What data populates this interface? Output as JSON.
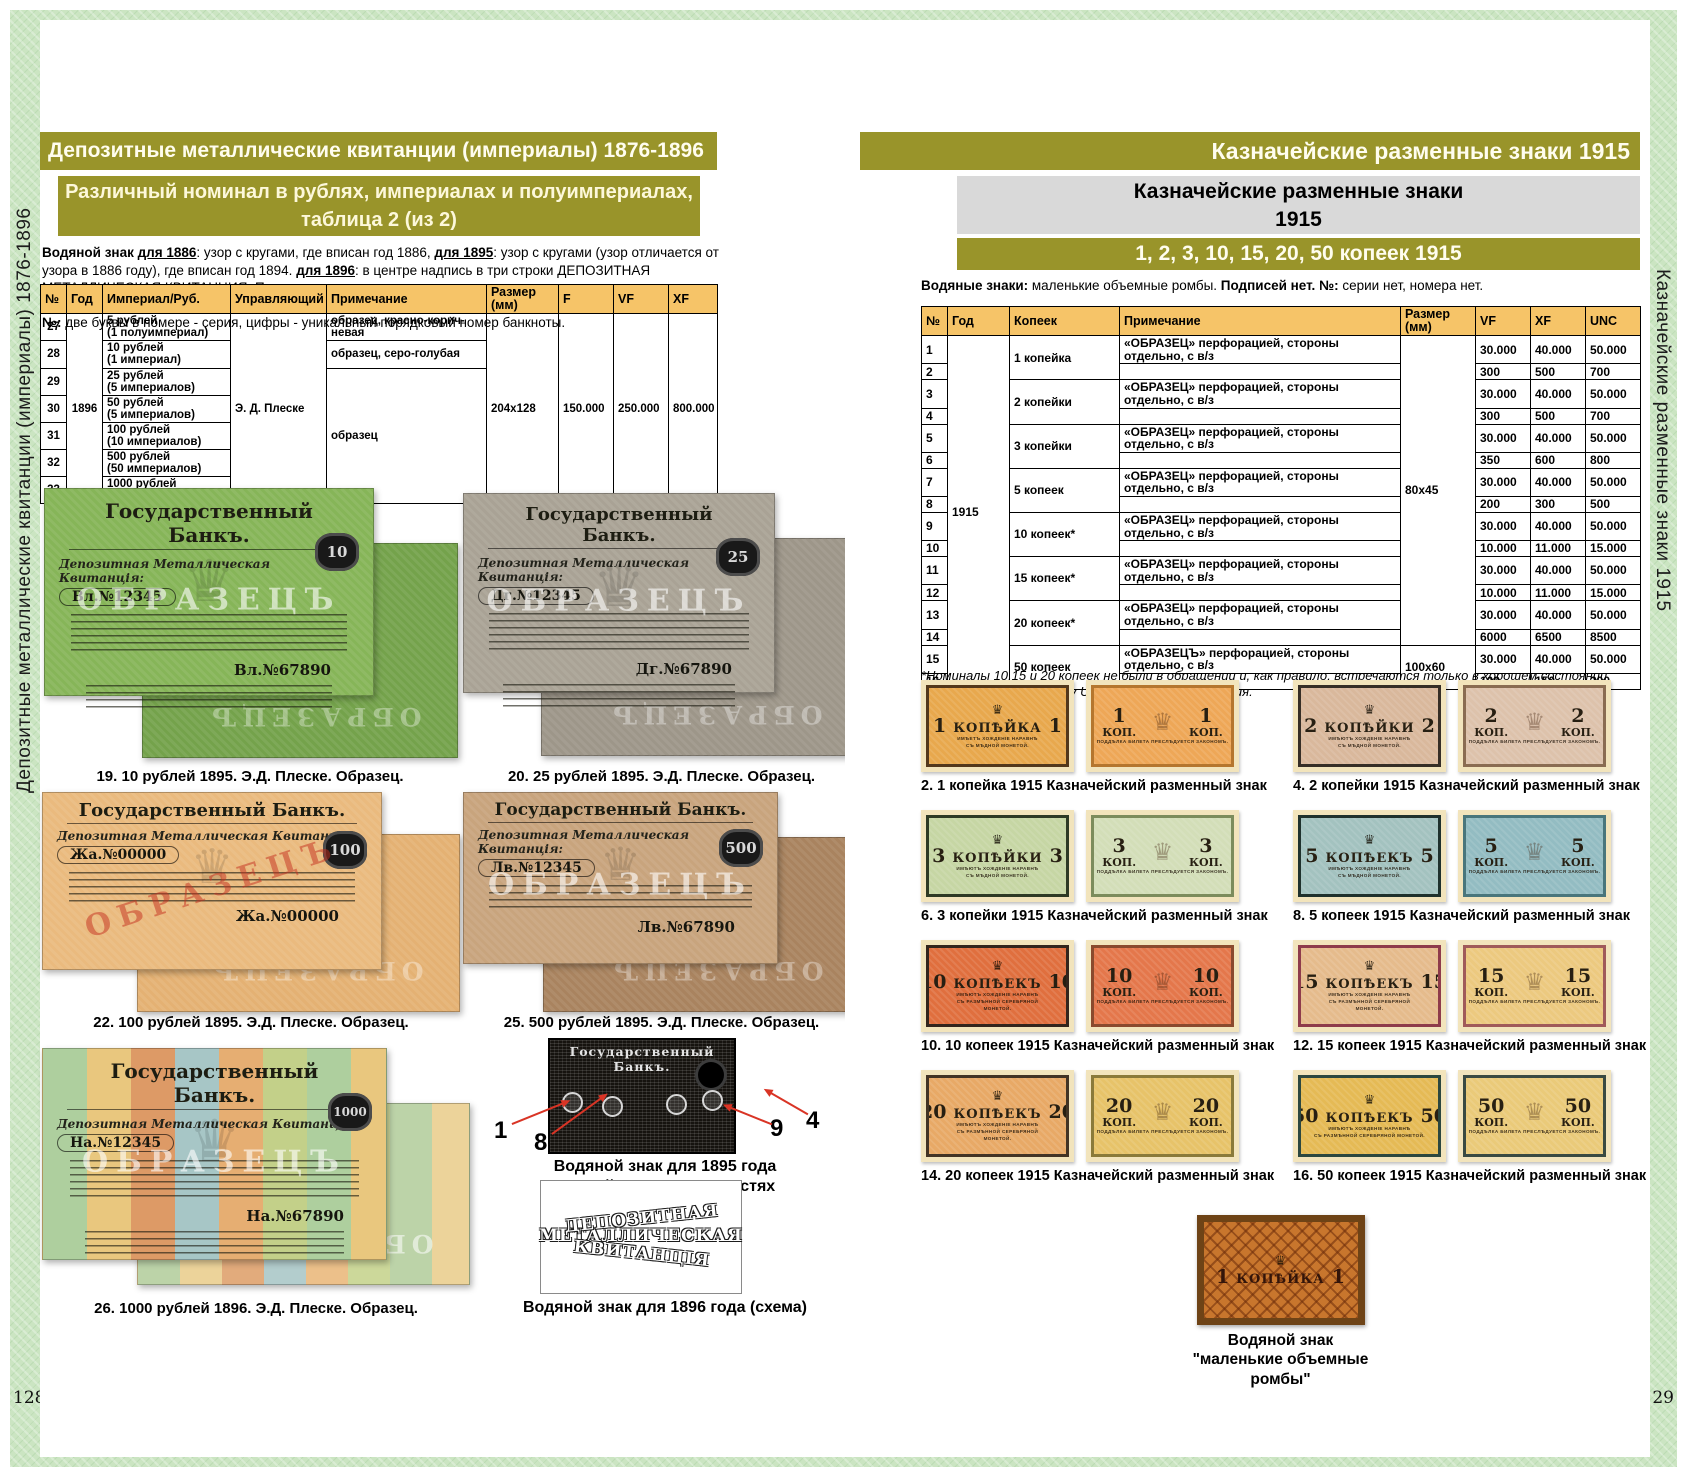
{
  "colors": {
    "accent_olive": "#99942a",
    "table_header": "#f6c468",
    "frame_green": "#cbe5c2",
    "arrow_red": "#d93425"
  },
  "icons": {
    "eagle": "♛"
  },
  "frame": {
    "sidebar_left": "Депозитные металлические квитанции (империалы) 1876-1896",
    "sidebar_right": "Казначейские разменные знаки 1915",
    "page_number_left": "128",
    "page_number_right": "129"
  },
  "left_page": {
    "header": "Депозитные металлические квитанции (империалы) 1876-1896",
    "subheader_line1": "Различный номинал в рублях, империалах и полуимпериалах,",
    "subheader_line2": "таблица 2 (из 2)",
    "intro": {
      "s1": "Водяной знак ",
      "s2": "для 1886",
      "s3": ": узор с кругами, где вписан год 1886, ",
      "s4": "для 1895",
      "s5": ": узор с кругами (узор отличается от узора в 1886 году), где вписан год 1894. ",
      "s6": "для 1896",
      "s7": ": в центре надпись в три строки ДЕПОЗИТНАЯ МЕТАЛЛИЧЕСКАЯ КВИТАНЦИЯ. По остальным годам водяные знаки автору неизвестны, если у вас есть информация, пишите на books@coinsmoscow.ru.",
      "s8": "№:",
      "s9": " две буквы в номере - серия, цифры - уникальный порядковый номер банкноты."
    },
    "table": {
      "headers": [
        "№",
        "Год",
        "Империал/Руб.",
        "Управляющий",
        "Примечание",
        "Размер (мм)",
        "F",
        "VF",
        "XF"
      ],
      "year": "1896",
      "manager": "Э. Д. Плеске",
      "size": "204x128",
      "f": "150.000",
      "vf": "250.000",
      "xf": "800.000",
      "note_27": "образец, красно-корич-невая",
      "note_28": "образец, серо-голубая",
      "note_29_33": "образец",
      "rows": [
        {
          "no": "27",
          "denom": "5 рублей\n(1 полуимпериал)"
        },
        {
          "no": "28",
          "denom": "10 рублей\n(1 империал)"
        },
        {
          "no": "29",
          "denom": "25 рублей\n(5 империалов)"
        },
        {
          "no": "30",
          "denom": "50 рублей\n(5 империалов)"
        },
        {
          "no": "31",
          "denom": "100 рублей\n(10 империалов)"
        },
        {
          "no": "32",
          "denom": "500 рублей\n(50 империалов)"
        },
        {
          "no": "33",
          "denom": "1000 рублей\n(100 империалов)"
        }
      ]
    },
    "bank_title": "Государственный Банкъ.",
    "bank_subtitle": "Депозитная Металлическая Квитанція:",
    "sample_overlay": "ОБРАЗЕЦЪ",
    "figures": [
      {
        "caption": "19. 10 рублей 1895. Э.Д. Плеске. Образец.",
        "serial1": "Вл.№12345",
        "serial2": "Вл.№67890",
        "badge": "10"
      },
      {
        "caption": "20. 25 рублей 1895. Э.Д. Плеске. Образец.",
        "serial1": "Дг.№12345",
        "serial2": "Дг.№67890",
        "badge": "25"
      },
      {
        "caption": "22. 100 рублей 1895. Э.Д. Плеске. Образец.",
        "serial1": "Жа.№00000",
        "serial2": "Жа.№00000",
        "badge": "100"
      },
      {
        "caption": "25. 500 рублей 1895. Э.Д. Плеске. Образец.",
        "serial1": "Лв.№12345",
        "serial2": "Лв.№67890",
        "badge": "500"
      },
      {
        "caption": "26. 1000 рублей 1896. Э.Д. Плеске. Образец.",
        "serial1": "На.№12345",
        "serial2": "На.№67890",
        "badge": "1000"
      }
    ],
    "wm1895": {
      "labels": [
        "1",
        "8",
        "9",
        "4"
      ],
      "caption_line1": "Водяной знак для 1895 года",
      "caption_line2": "с датой 1894 в окружностях"
    },
    "wm1896": {
      "arc1": "ДЕПОЗИТНАЯ",
      "arc2": "МЕТАЛЛИЧЕСКАЯ",
      "arc3": "КВИТАНЦІЯ",
      "caption": "Водяной знак для 1896 года (схема)"
    }
  },
  "right_page": {
    "header": "Казначейские разменные знаки 1915",
    "graybox_line1": "Казначейские разменные знаки",
    "graybox_line2": "1915",
    "subbar": "1, 2, 3, 10, 15, 20, 50 копеек 1915",
    "intro": {
      "s1": "Водяные знаки:",
      "s2": " маленькие объемные ромбы. ",
      "s3": "Подписей нет.",
      "s4": " ",
      "s5": "№:",
      "s6": " серии нет, номера нет."
    },
    "table": {
      "headers": [
        "№",
        "Год",
        "Копеек",
        "Примечание",
        "Размер (мм)",
        "VF",
        "XF",
        "UNC"
      ],
      "year": "1915",
      "size_small": "80x45",
      "size_large": "100x60",
      "note": "«ОБРАЗЕЦ» перфорацией, стороны отдельно, с в/з",
      "note_50": "«ОБРАЗЕЦЪ» перфорацией, стороны отдельно, с в/з",
      "kopeks": [
        "1 копейка",
        "2 копейки",
        "3 копейки",
        "5 копеек",
        "10 копеек*",
        "15 копеек*",
        "20 копеек*",
        "50 копеек"
      ],
      "rows": [
        {
          "no": "1",
          "vf": "30.000",
          "xf": "40.000",
          "unc": "50.000"
        },
        {
          "no": "2",
          "vf": "300",
          "xf": "500",
          "unc": "700"
        },
        {
          "no": "3",
          "vf": "30.000",
          "xf": "40.000",
          "unc": "50.000"
        },
        {
          "no": "4",
          "vf": "300",
          "xf": "500",
          "unc": "700"
        },
        {
          "no": "5",
          "vf": "30.000",
          "xf": "40.000",
          "unc": "50.000"
        },
        {
          "no": "6",
          "vf": "350",
          "xf": "600",
          "unc": "800"
        },
        {
          "no": "7",
          "vf": "30.000",
          "xf": "40.000",
          "unc": "50.000"
        },
        {
          "no": "8",
          "vf": "200",
          "xf": "300",
          "unc": "500"
        },
        {
          "no": "9",
          "vf": "30.000",
          "xf": "40.000",
          "unc": "50.000"
        },
        {
          "no": "10",
          "vf": "10.000",
          "xf": "11.000",
          "unc": "15.000"
        },
        {
          "no": "11",
          "vf": "30.000",
          "xf": "40.000",
          "unc": "50.000"
        },
        {
          "no": "12",
          "vf": "10.000",
          "xf": "11.000",
          "unc": "15.000"
        },
        {
          "no": "13",
          "vf": "30.000",
          "xf": "40.000",
          "unc": "50.000"
        },
        {
          "no": "14",
          "vf": "6000",
          "xf": "6500",
          "unc": "8500"
        },
        {
          "no": "15",
          "vf": "30.000",
          "xf": "40.000",
          "unc": "50.000"
        },
        {
          "no": "16",
          "vf": "100",
          "xf": "150",
          "unc": "300"
        }
      ]
    },
    "footnote": "*Номиналы 10,15 и 20 копеек не были в обращении и, как правило, встречаются только в хорошем состоянии,\nпоэтому мы ввели шкалу UNC для оценки состояния.",
    "banknotes": [
      {
        "value": "1",
        "name": "КОПѢЙКА",
        "fl1": "ИМѢЕТЪ ХОЖДЕНІЕ НАРАВНѢ",
        "fl2": "СЪ МѢДНОЙ МОНЕТОЙ.",
        "fl3": "",
        "kop": "КОП.",
        "back_line": "ПОДДѢЛКА БИЛЕТА ПРЕСЛѢДУЕТСЯ ЗАКОНОМЪ.",
        "caption": "2. 1 копейка 1915 Казначейский разменный знак",
        "ff": "#e8a84d",
        "fb": "#53381c",
        "bf": "#eea757",
        "bb": "#b5762e"
      },
      {
        "value": "2",
        "name": "КОПѢЙКИ",
        "fl1": "ИМѢЮТЪ ХОЖДЕНІЕ НАРАВНѢ",
        "fl2": "СЪ МѢДНОЙ МОНЕТОЙ.",
        "fl3": "",
        "kop": "КОП.",
        "back_line": "ПОДДѢЛКА БИЛЕТА ПРЕСЛѢДУЕТСЯ ЗАКОНОМЪ.",
        "caption": "4. 2 копейки 1915 Казначейский разменный знак",
        "ff": "#d9b89c",
        "fb": "#362e26",
        "bf": "#ddc2ab",
        "bb": "#8a6c52"
      },
      {
        "value": "3",
        "name": "КОПѢЙКИ",
        "fl1": "ИМѢЮТЪ ХОЖДЕНІЕ НАРАВНѢ",
        "fl2": "СЪ МѢДНОЙ МОНЕТОЙ.",
        "fl3": "",
        "kop": "КОП.",
        "back_line": "ПОДДѢЛКА БИЛЕТА ПРЕСЛѢДУЕТСЯ ЗАКОНОМЪ.",
        "caption": "6. 3 копейки 1915 Казначейский разменный знак",
        "ff": "#c6d6a4",
        "fb": "#2e3a25",
        "bf": "#d3deb8",
        "bb": "#7c8c5c"
      },
      {
        "value": "5",
        "name": "КОПѢЕКЪ",
        "fl1": "ИМѢЮТЪ ХОЖДЕНІЕ НАРАВНѢ",
        "fl2": "СЪ МѢДНОЙ МОНЕТОЙ.",
        "fl3": "",
        "kop": "КОП.",
        "back_line": "ПОДДѢЛКА БИЛЕТА ПРЕСЛѢДУЕТСЯ ЗАКОНОМЪ.",
        "caption": "8. 5 копеек 1915 Казначейский разменный знак",
        "ff": "#a3c2bf",
        "fb": "#1f312d",
        "bf": "#93bcc2",
        "bb": "#49767c"
      },
      {
        "value": "10",
        "name": "КОПѢЕКЪ",
        "fl1": "ИМѢЮТЪ ХОЖДЕНІЕ НАРАВНѢ",
        "fl2": "СЪ РАЗМѢННОЙ СЕРЕБРЯНОЙ",
        "fl3": "МОНЕТОЙ.",
        "kop": "КОП.",
        "back_line": "ПОДДѢЛКА БИЛЕТА ПРЕСЛѢДУЕТСЯ ЗАКОНОМЪ.",
        "caption": "10. 10 копеек 1915 Казначейский разменный знак",
        "ff": "#e06f3e",
        "fb": "#33251d",
        "bf": "#e4774b",
        "bb": "#8a4a2e"
      },
      {
        "value": "15",
        "name": "КОПѢЕКЪ",
        "fl1": "ИМѢЮТЪ ХОЖДЕНІЕ НАРАВНѢ",
        "fl2": "СЪ РАЗМѢННОЙ СЕРЕБРЯНОЙ",
        "fl3": "МОНЕТОЙ.",
        "kop": "КОП.",
        "back_line": "ПОДДѢЛКА БИЛЕТА ПРЕСЛѢДУЕТСЯ ЗАКОНОМЪ.",
        "caption": "12. 15 копеек 1915 Казначейский разменный знак",
        "ff": "#e5bb8c",
        "fb": "#8e3b4b",
        "bf": "#ecc97f",
        "bb": "#a05a5a"
      },
      {
        "value": "20",
        "name": "КОПѢЕКЪ",
        "fl1": "ИМѢЮТЪ ХОЖДЕНІЕ НАРАВНѢ",
        "fl2": "СЪ РАЗМѢННОЙ СЕРЕБРЯНОЙ",
        "fl3": "МОНЕТОЙ.",
        "kop": "КОП.",
        "back_line": "ПОДДѢЛКА БИЛЕТА ПРЕСЛѢДУЕТСЯ ЗАКОНОМЪ.",
        "caption": "14. 20 копеек 1915 Казначейский разменный знак",
        "ff": "#e8a966",
        "fb": "#433425",
        "bf": "#e7c369",
        "bb": "#8a7a3a"
      },
      {
        "value": "50",
        "name": "КОПѢЕКЪ",
        "fl1": "ИМѢЮТЪ ХОЖДЕНІЕ НАРАВНѢ",
        "fl2": "СЪ РАЗМѢННОЙ СЕРЕБРЯНОЙ МОНЕТОЙ.",
        "fl3": "",
        "kop": "КОП.",
        "back_line": "ПОДДѢЛКА БИЛЕТА ПРЕСЛѢДУЕТСЯ ЗАКОНОМЪ.",
        "caption": "16. 50 копеек 1915 Казначейский разменный знак",
        "ff": "#e5ba55",
        "fb": "#2c473f",
        "bf": "#eaca79",
        "bb": "#3a4a42"
      }
    ],
    "wm": {
      "image_value": "1",
      "image_name": "КОПѢЙКА",
      "caption_line1": "Водяной знак",
      "caption_line2": "\"маленькие объемные",
      "caption_line3": "ромбы\""
    }
  }
}
